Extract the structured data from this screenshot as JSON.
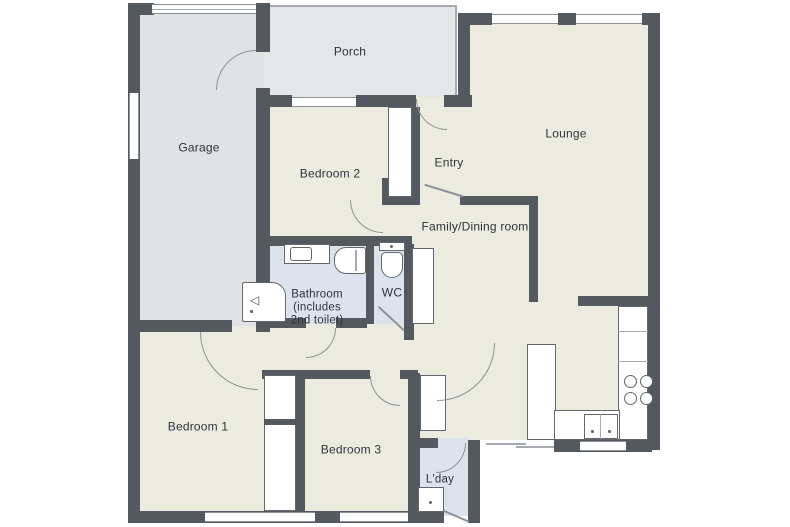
{
  "title": "Residential floor plan",
  "colors": {
    "wall": "#54585f",
    "room_floor": "#ebebdf",
    "garage_floor": "#e1e2e4",
    "porch_floor": "#e4e5e7",
    "wet_room_floor": "#dde3ed",
    "door_line": "#8d9197"
  },
  "rooms": {
    "porch": "Porch",
    "garage": "Garage",
    "bedroom2": "Bedroom 2",
    "entry": "Entry",
    "lounge": "Lounge",
    "family_dining": "Family/Dining room",
    "bathroom": "Bathroom\n(includes\n2nd toilet)",
    "wc": "WC",
    "bedroom1": "Bedroom 1",
    "bedroom3": "Bedroom 3",
    "laundry": "L'day"
  },
  "fixtures": {
    "shower_glyph": "◁"
  }
}
